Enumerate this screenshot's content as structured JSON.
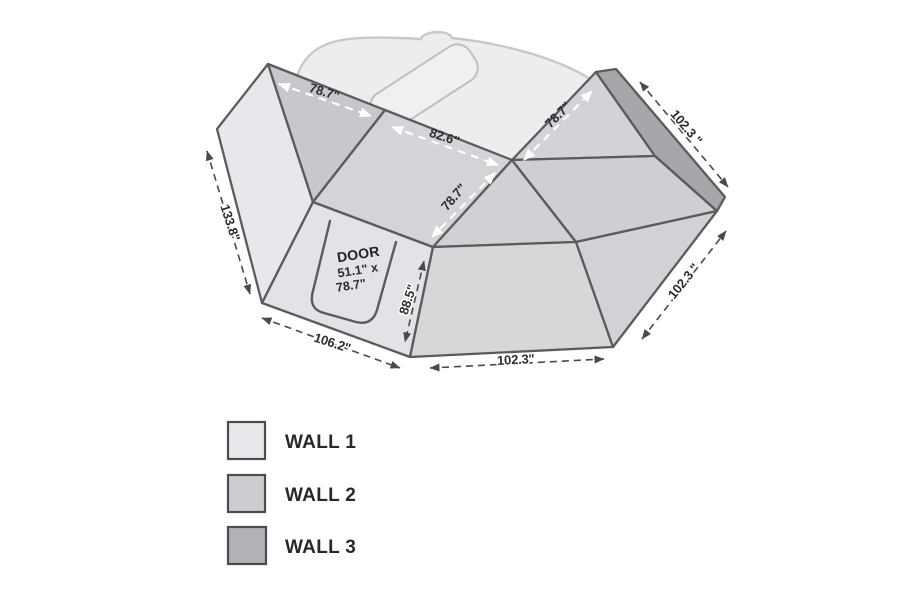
{
  "diagram_title": "awning-wall-kit-dimensions",
  "dims": {
    "top_left": "78.7\"",
    "top_mid": "82.6\"",
    "mid_fold": "78.7\"",
    "right_fold": "78.7\"",
    "left_edge": "133.8\"",
    "front_bottom": "106.2\"",
    "door_height": "88.5\"",
    "bottom": "102.3\"",
    "right_diag": "102.3 \"",
    "top_right": "102.3 \""
  },
  "door": {
    "title": "DOOR",
    "dim1": "51.1\" x",
    "dim2": "78.7\""
  },
  "legend": {
    "items": [
      {
        "label": "WALL 1",
        "color": "#e8e8ec"
      },
      {
        "label": "WALL 2",
        "color": "#cdcdd1"
      },
      {
        "label": "WALL 3",
        "color": "#b2b2b6"
      }
    ]
  },
  "colors": {
    "outline": "#5b5b5f",
    "dim_line": "#4a4a4e",
    "wall_light": "#e8e8ec",
    "wall_mid": "#d3d3d7",
    "wall_dark_strip": "#a7a7ab"
  }
}
